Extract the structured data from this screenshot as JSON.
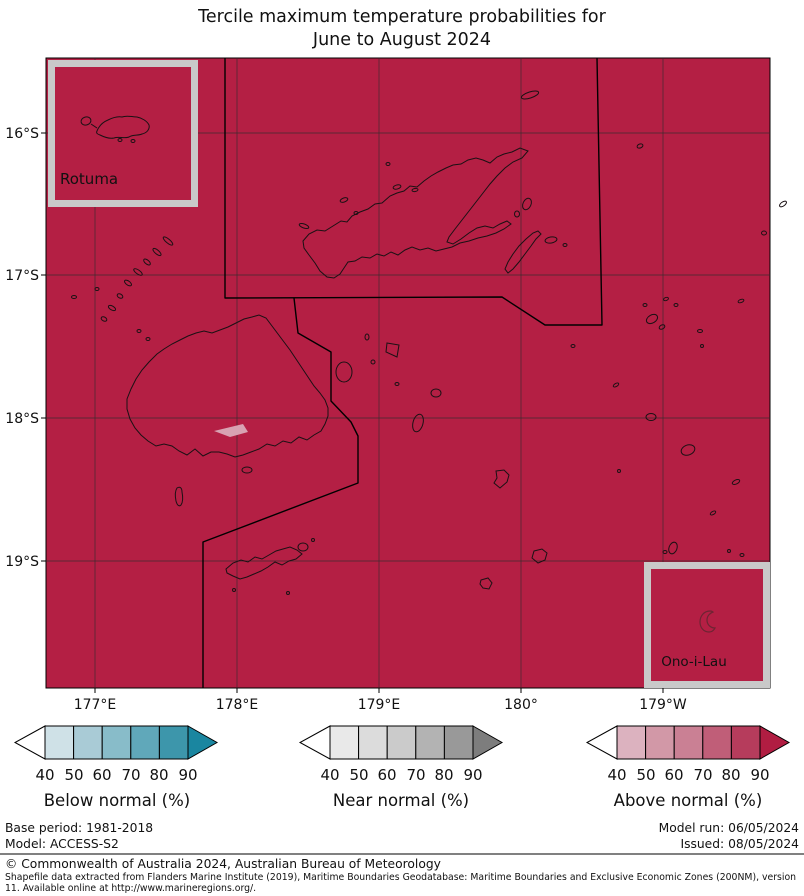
{
  "title": {
    "line1": "Tercile maximum temperature probabilities for",
    "line2": "June to August 2024"
  },
  "map": {
    "fill_color": "#b41f44",
    "anomaly_patch_color": "#d8a2b2",
    "inset_border_color": "#c9c9c9",
    "lat_ticks": [
      "16°S",
      "17°S",
      "18°S",
      "19°S"
    ],
    "lon_ticks": [
      "177°E",
      "178°E",
      "179°E",
      "180°",
      "179°W"
    ],
    "insets": {
      "rotuma_label": "Rotuma",
      "ono_i_lau_label": "Ono-i-Lau"
    }
  },
  "legend": {
    "tick_values": [
      "40",
      "50",
      "60",
      "70",
      "80",
      "90"
    ],
    "bars": [
      {
        "label": "Below normal (%)",
        "under_color": "#ffffff",
        "segment_colors": [
          "#cfe1e7",
          "#a9cbd6",
          "#88bcc9",
          "#60a8ba",
          "#3d96ab"
        ],
        "arrow_color": "#1a86a0"
      },
      {
        "label": "Near normal (%)",
        "under_color": "#ffffff",
        "segment_colors": [
          "#e9e9e9",
          "#dcdcdc",
          "#cbcbcb",
          "#b3b3b3",
          "#999999"
        ],
        "arrow_color": "#7d7d7d"
      },
      {
        "label": "Above normal (%)",
        "under_color": "#ffffff",
        "segment_colors": [
          "#dcb2bf",
          "#d298a7",
          "#ca8094",
          "#c05e78",
          "#b63c5c"
        ],
        "arrow_color": "#b11d42"
      }
    ]
  },
  "footer": {
    "base_period": "Base period: 1981-2018",
    "model": "Model: ACCESS-S2",
    "model_run": "Model run: 06/05/2024",
    "issued": "Issued: 08/05/2024",
    "copyright": "© Commonwealth of Australia 2024, Australian Bureau of Meteorology",
    "shapefile_line1": "Shapefile data extracted from Flanders Marine Institute (2019), Maritime Boundaries Geodatabase: Maritime Boundaries and Exclusive Economic Zones (200NM), version",
    "shapefile_line2": "11. Available online at http://www.marineregions.org/."
  }
}
